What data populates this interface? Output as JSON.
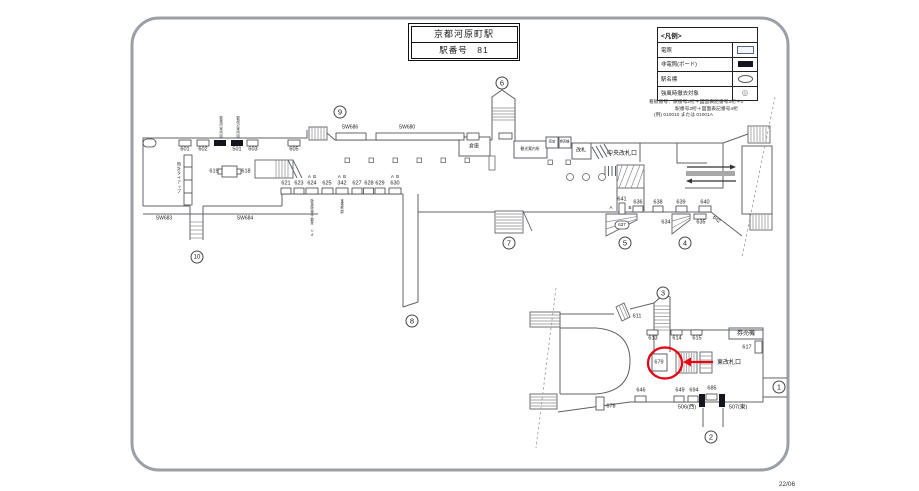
{
  "header": {
    "station_name": "京都河原町駅",
    "station_number_label": "駅番号　81"
  },
  "legend": {
    "title": "<凡例>",
    "rows": [
      {
        "label": "電照",
        "swatch": "lit"
      },
      {
        "label": "非電照(ボード)",
        "swatch": "board"
      },
      {
        "label": "駅名標",
        "swatch": "oval"
      },
      {
        "label": "強風時撤去対象",
        "swatch": "remove"
      }
    ],
    "remove_symbol": "◎",
    "notes": [
      "看板番号：駅番号2桁＋図面表記番号3桁＋0",
      "駅番号2桁＋図面表記番号4桁",
      "(例) 010010 または 01001A"
    ]
  },
  "revision_date": "22/06",
  "highlight": {
    "label": "679",
    "color": "#e60012",
    "arrow": "left",
    "gate": "東改札口"
  },
  "diagram": {
    "labels": [
      {
        "id": "b601",
        "t": "601",
        "x": 185,
        "y": 150
      },
      {
        "id": "b602",
        "t": "602",
        "x": 203,
        "y": 150
      },
      {
        "id": "b501",
        "t": "501",
        "x": 237,
        "y": 150
      },
      {
        "id": "b603",
        "t": "603",
        "x": 253,
        "y": 150
      },
      {
        "id": "b605",
        "t": "605",
        "x": 294,
        "y": 150
      },
      {
        "id": "vtext-board1",
        "t": "駅構内案内図",
        "x": 220,
        "y": 116,
        "s": 3.2,
        "v": 1
      },
      {
        "id": "vtext-board2",
        "t": "駅周辺案内図",
        "x": 237,
        "y": 116,
        "s": 3.2,
        "v": 1
      },
      {
        "id": "b619",
        "t": "619",
        "x": 214,
        "y": 172
      },
      {
        "id": "b618",
        "t": "618",
        "x": 246,
        "y": 172
      },
      {
        "id": "vtext-clock",
        "t": "時計タイアップ",
        "x": 179,
        "y": 162,
        "s": 4,
        "v": 1
      },
      {
        "id": "sw686",
        "t": "SW686",
        "x": 350,
        "y": 128,
        "s": 5
      },
      {
        "id": "sw680",
        "t": "SW680",
        "x": 407,
        "y": 128,
        "s": 5
      },
      {
        "id": "sw683",
        "t": "SW683",
        "x": 164,
        "y": 219,
        "s": 5
      },
      {
        "id": "sw684",
        "t": "SW684",
        "x": 245,
        "y": 219,
        "s": 5
      },
      {
        "id": "b621",
        "t": "621",
        "x": 286,
        "y": 184
      },
      {
        "id": "b623",
        "t": "623",
        "x": 299,
        "y": 184
      },
      {
        "id": "b624",
        "t": "624",
        "x": 312,
        "y": 184
      },
      {
        "id": "b625",
        "t": "625",
        "x": 327,
        "y": 184
      },
      {
        "id": "b626",
        "t": "342",
        "x": 342,
        "y": 184
      },
      {
        "id": "b627",
        "t": "627",
        "x": 357,
        "y": 184
      },
      {
        "id": "b628",
        "t": "628",
        "x": 369,
        "y": 184
      },
      {
        "id": "b629",
        "t": "629",
        "x": 380,
        "y": 184
      },
      {
        "id": "b630",
        "t": "630",
        "x": 395,
        "y": 184
      },
      {
        "id": "ab624",
        "t": "A  B",
        "x": 312,
        "y": 176.5,
        "s": 4.5
      },
      {
        "id": "ab626",
        "t": "A  B",
        "x": 342,
        "y": 176.5,
        "s": 4.5
      },
      {
        "id": "ab630",
        "t": "A  B",
        "x": 395,
        "y": 176.5,
        "s": 4.5
      },
      {
        "id": "vtext-624",
        "t": "阪急阪神不動産 ジオ",
        "x": 311,
        "y": 199,
        "s": 3.2,
        "v": 1
      },
      {
        "id": "vtext-626",
        "t": "宝塚歌劇",
        "x": 341,
        "y": 199,
        "s": 3.2,
        "v": 1
      },
      {
        "id": "room-soko",
        "t": "倉庫",
        "x": 474,
        "y": 147,
        "s": 5
      },
      {
        "id": "room-kanko",
        "t": "観光案内所",
        "x": 530,
        "y": 150,
        "s": 3.8
      },
      {
        "id": "room-baiten",
        "t": "売店",
        "x": 552,
        "y": 142,
        "s": 3.5
      },
      {
        "id": "room-kenbaiki-top",
        "t": "券売機",
        "x": 564.5,
        "y": 142,
        "s": 3.2
      },
      {
        "id": "room-kaisatsu",
        "t": "改札",
        "x": 581,
        "y": 151,
        "s": 5
      },
      {
        "id": "gate-chuo",
        "t": "中央改札口",
        "x": 622,
        "y": 154,
        "s": 6
      },
      {
        "id": "b641",
        "t": "641",
        "x": 622,
        "y": 200
      },
      {
        "id": "b641-a",
        "t": "A",
        "x": 611,
        "y": 208,
        "s": 4.5
      },
      {
        "id": "b641-b",
        "t": "B",
        "x": 630,
        "y": 208,
        "s": 4.5
      },
      {
        "id": "b637",
        "t": "637",
        "x": 622,
        "y": 225,
        "s": 4.5
      },
      {
        "id": "b636",
        "t": "636",
        "x": 638,
        "y": 203
      },
      {
        "id": "b638",
        "t": "638",
        "x": 658,
        "y": 203
      },
      {
        "id": "b639",
        "t": "639",
        "x": 681,
        "y": 203
      },
      {
        "id": "b640",
        "t": "640",
        "x": 705,
        "y": 203
      },
      {
        "id": "b634",
        "t": "634",
        "x": 666,
        "y": 223
      },
      {
        "id": "b635",
        "t": "635",
        "x": 701,
        "y": 223
      },
      {
        "id": "b642",
        "t": "642",
        "x": 716,
        "y": 220,
        "s": 5,
        "r": 40
      },
      {
        "id": "b611",
        "t": "611",
        "x": 637,
        "y": 317
      },
      {
        "id": "b613",
        "t": "613",
        "x": 653,
        "y": 339
      },
      {
        "id": "b614",
        "t": "614",
        "x": 677,
        "y": 339
      },
      {
        "id": "b615",
        "t": "615",
        "x": 697,
        "y": 339
      },
      {
        "id": "room-kenbaiki-btm",
        "t": "券売機",
        "x": 746,
        "y": 333.5,
        "s": 6
      },
      {
        "id": "b617",
        "t": "617",
        "x": 747,
        "y": 348
      },
      {
        "id": "b679",
        "t": "679",
        "x": 659,
        "y": 363
      },
      {
        "id": "gate-higashi",
        "t": "東改札口",
        "x": 729,
        "y": 363,
        "s": 6
      },
      {
        "id": "b646",
        "t": "646",
        "x": 641,
        "y": 391
      },
      {
        "id": "b649",
        "t": "649",
        "x": 680,
        "y": 391
      },
      {
        "id": "b650",
        "t": "694",
        "x": 694,
        "y": 391
      },
      {
        "id": "b685",
        "t": "685",
        "x": 712,
        "y": 389
      },
      {
        "id": "b506",
        "t": "506(西)",
        "x": 687,
        "y": 408
      },
      {
        "id": "b507",
        "t": "507(東)",
        "x": 738,
        "y": 408
      },
      {
        "id": "b678",
        "t": "678",
        "x": 611,
        "y": 407
      }
    ],
    "circled_numbers": [
      {
        "n": "1",
        "x": 779,
        "y": 387
      },
      {
        "n": "2",
        "x": 711,
        "y": 437
      },
      {
        "n": "3",
        "x": 663,
        "y": 293
      },
      {
        "n": "4",
        "x": 685,
        "y": 243
      },
      {
        "n": "5",
        "x": 625,
        "y": 243
      },
      {
        "n": "6",
        "x": 502,
        "y": 83
      },
      {
        "n": "7",
        "x": 509,
        "y": 243
      },
      {
        "n": "8",
        "x": 412,
        "y": 321
      },
      {
        "n": "9",
        "x": 340,
        "y": 112
      },
      {
        "n": "10",
        "x": 197,
        "y": 257
      }
    ]
  }
}
